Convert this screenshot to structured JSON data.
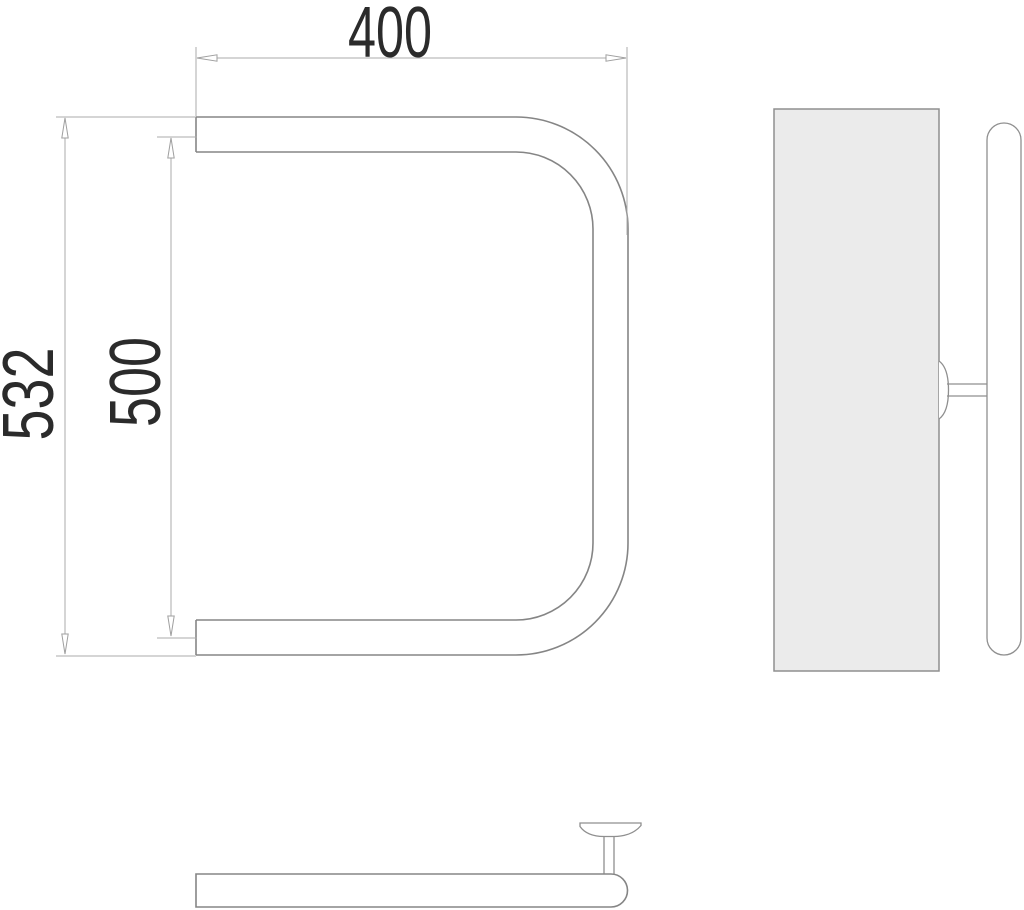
{
  "drawing": {
    "kind": "technical-drawing-three-views",
    "subject": "towel-rail",
    "dimensions": {
      "top_width": "400",
      "inner_height": "500",
      "overall_height": "532"
    },
    "colors": {
      "background": "#ffffff",
      "outline": "#858585",
      "dimension_lines": "#ababab",
      "dimension_text": "#2b2b2b",
      "wall_plate_fill": "#ebebeb"
    }
  }
}
